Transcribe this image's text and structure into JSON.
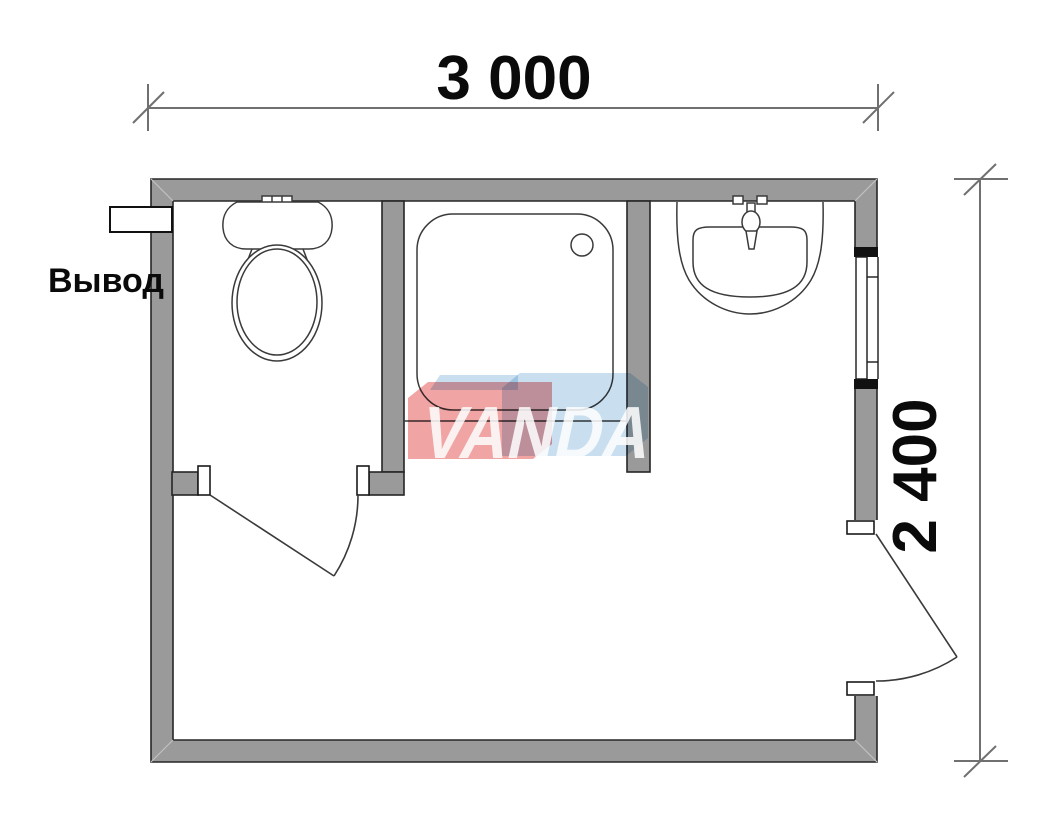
{
  "plan": {
    "title": "bathroom-floor-plan",
    "width_label": "3 000",
    "height_label": "2 400",
    "outlet_label": "Вывод",
    "watermark_text": "VANDA"
  },
  "colors": {
    "wall_fill": "#9a9a9a",
    "wall_outline": "#262626",
    "fixture_line": "#3a3a3a",
    "dimension_line": "#707070",
    "dimension_text": "#0a0a0a",
    "watermark_red": "#f0a4a4",
    "watermark_blue": "#c9dff0",
    "miter_line": "#c2c2c2"
  }
}
